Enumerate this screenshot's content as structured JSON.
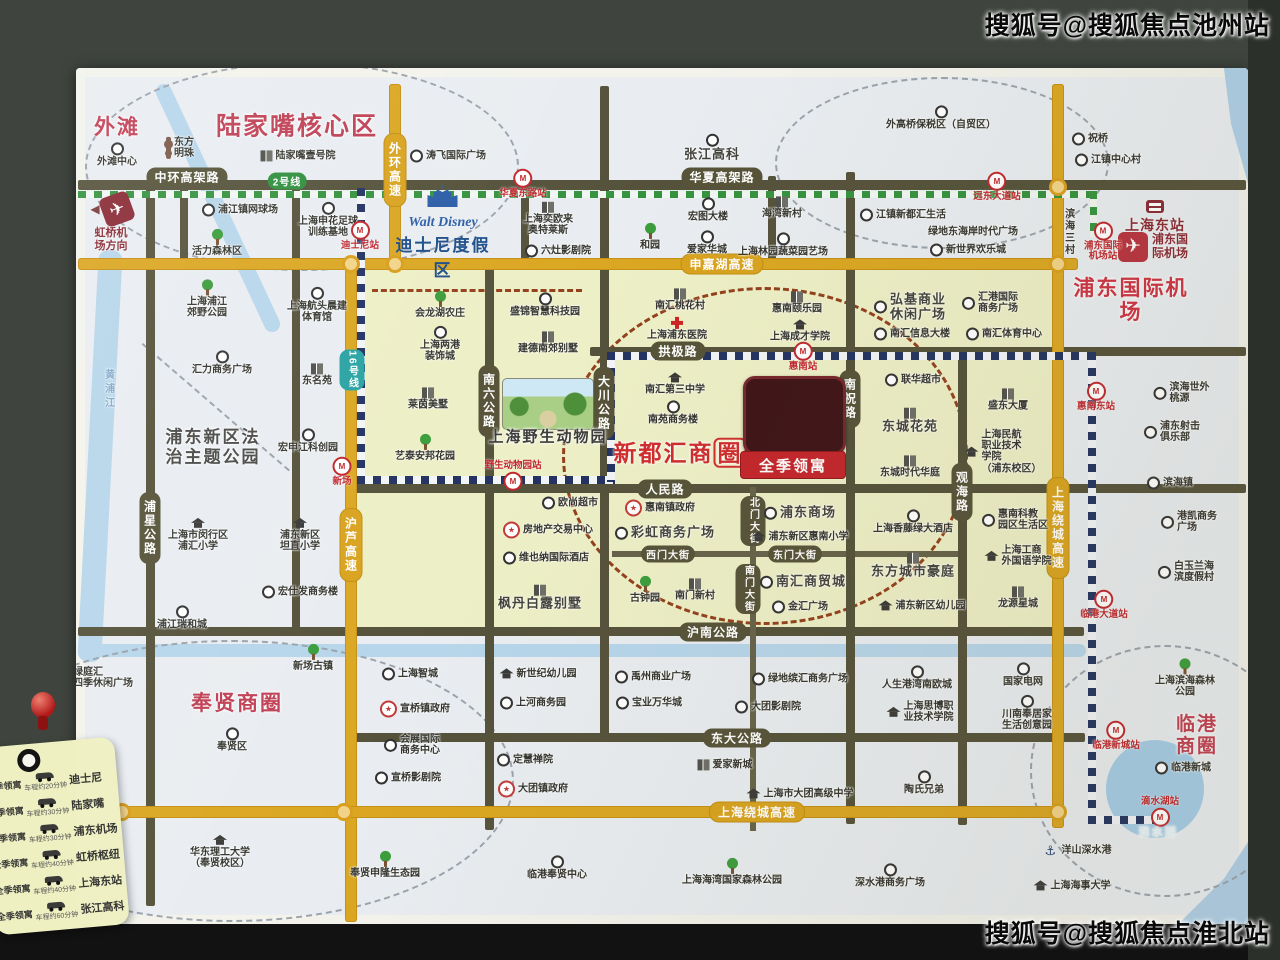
{
  "watermarks": {
    "top": "搜狐号@搜狐焦点池州站",
    "bottom": "搜狐号@搜狐焦点淮北站"
  },
  "project": {
    "name": "全季领寓"
  },
  "special": {
    "disney": {
      "logo": "Walt Disney",
      "title": "迪士尼度假区"
    },
    "hongqiao": {
      "label": "虹桥机\n场方向"
    },
    "east_station": {
      "label": "上海东站"
    },
    "airport_icon_label": "浦东国\n际机场"
  },
  "legend": {
    "origin": "全季领寓",
    "rows": [
      {
        "dest": "迪士尼",
        "time": "车程约20分钟"
      },
      {
        "dest": "陆家嘴",
        "time": "车程约30分钟"
      },
      {
        "dest": "浦东机场",
        "time": "车程约30分钟"
      },
      {
        "dest": "虹桥枢纽",
        "time": "车程约40分钟"
      },
      {
        "dest": "上海东站",
        "time": "车程约40分钟"
      },
      {
        "dest": "张江高科",
        "time": "车程约60分钟"
      }
    ]
  },
  "zones": [
    {
      "x": 351,
      "y": 264,
      "w": 713,
      "h": 370
    }
  ],
  "rivers": [
    {
      "x": 88,
      "y": 250,
      "w": 24,
      "h": 412,
      "r": 3
    },
    {
      "x": 210,
      "y": 72,
      "w": 16,
      "h": 272,
      "r": -25
    },
    {
      "x": 78,
      "y": 644,
      "w": 1008,
      "h": 13,
      "r": 0
    }
  ],
  "circles": [
    {
      "x": 85,
      "y": 62,
      "w": 430,
      "h": 205,
      "c": "gray"
    },
    {
      "x": 775,
      "y": 77,
      "w": 330,
      "h": 168,
      "c": "gray"
    },
    {
      "x": 1030,
      "y": 645,
      "w": 266,
      "h": 248,
      "c": "gray"
    },
    {
      "x": -50,
      "y": 640,
      "w": 560,
      "h": 278,
      "c": "gray"
    },
    {
      "x": 562,
      "y": 287,
      "w": 400,
      "h": 332,
      "c": "red"
    }
  ],
  "dsegs": [
    {
      "x": 143,
      "y": 343,
      "len": 194,
      "ang": 40.8,
      "c": "gray"
    },
    {
      "x": 372,
      "y": 289,
      "len": 210,
      "ang": 0,
      "c": "red"
    }
  ],
  "roads": [
    {
      "x": 78,
      "y": 180,
      "w": 1168,
      "h": 10,
      "t": "dark"
    },
    {
      "x": 590,
      "y": 347,
      "w": 656,
      "h": 9,
      "t": "dark"
    },
    {
      "x": 350,
      "y": 484,
      "w": 896,
      "h": 9,
      "t": "dark"
    },
    {
      "x": 612,
      "y": 551,
      "w": 348,
      "h": 6,
      "t": "thin"
    },
    {
      "x": 78,
      "y": 627,
      "w": 1006,
      "h": 9,
      "t": "dark"
    },
    {
      "x": 345,
      "y": 733,
      "w": 740,
      "h": 9,
      "t": "dark"
    },
    {
      "x": 146,
      "y": 186,
      "w": 9,
      "h": 720,
      "t": "dark"
    },
    {
      "x": 292,
      "y": 186,
      "w": 8,
      "h": 446,
      "t": "dark"
    },
    {
      "x": 600,
      "y": 86,
      "w": 9,
      "h": 652,
      "t": "dark"
    },
    {
      "x": 846,
      "y": 172,
      "w": 9,
      "h": 652,
      "t": "dark"
    },
    {
      "x": 958,
      "y": 347,
      "w": 9,
      "h": 478,
      "t": "dark"
    },
    {
      "x": 485,
      "y": 262,
      "w": 9,
      "h": 568,
      "t": "dark"
    },
    {
      "x": 521,
      "y": 186,
      "w": 8,
      "h": 84,
      "t": "dark"
    },
    {
      "x": 768,
      "y": 176,
      "w": 8,
      "h": 94,
      "t": "dark"
    },
    {
      "x": 750,
      "y": 487,
      "w": 6,
      "h": 344,
      "t": "thin"
    },
    {
      "x": 180,
      "y": 186,
      "w": 8,
      "h": 82,
      "t": "dark"
    }
  ],
  "yroads": [
    {
      "x": 389,
      "y": 84,
      "w": 12,
      "h": 184
    },
    {
      "x": 78,
      "y": 258,
      "w": 1000,
      "h": 12
    },
    {
      "x": 345,
      "y": 258,
      "w": 12,
      "h": 664
    },
    {
      "x": 1052,
      "y": 84,
      "w": 12,
      "h": 744
    },
    {
      "x": 78,
      "y": 806,
      "w": 988,
      "h": 12
    }
  ],
  "rails": [
    {
      "x": 78,
      "y": 191,
      "w": 1016,
      "h": 7,
      "o": "h",
      "l": "l2"
    },
    {
      "x": 1090,
      "y": 191,
      "w": 7,
      "h": 46,
      "o": "v",
      "l": "l2"
    },
    {
      "x": 357,
      "y": 188,
      "w": 8,
      "h": 294,
      "o": "v",
      "l": "l16"
    },
    {
      "x": 357,
      "y": 476,
      "w": 258,
      "h": 8,
      "o": "h",
      "l": "l16"
    },
    {
      "x": 607,
      "y": 352,
      "w": 8,
      "h": 130,
      "o": "v",
      "l": "l16"
    },
    {
      "x": 607,
      "y": 352,
      "w": 488,
      "h": 8,
      "o": "h",
      "l": "l16"
    },
    {
      "x": 1088,
      "y": 352,
      "w": 8,
      "h": 470,
      "o": "v",
      "l": "l16"
    },
    {
      "x": 1088,
      "y": 816,
      "w": 66,
      "h": 8,
      "o": "h",
      "l": "l16"
    }
  ],
  "nodes": [
    {
      "x": 351,
      "y": 264
    },
    {
      "x": 395,
      "y": 264
    },
    {
      "x": 1058,
      "y": 187
    },
    {
      "x": 1058,
      "y": 264
    },
    {
      "x": 122,
      "y": 812
    },
    {
      "x": 344,
      "y": 812
    },
    {
      "x": 1058,
      "y": 812
    }
  ],
  "road_labels": [
    {
      "t": "中环高架路",
      "x": 187,
      "y": 177,
      "c": "dark"
    },
    {
      "t": "华夏高架路",
      "x": 722,
      "y": 177,
      "c": "dark"
    },
    {
      "t": "拱极路",
      "x": 678,
      "y": 351,
      "c": "dark"
    },
    {
      "t": "人民路",
      "x": 665,
      "y": 489,
      "c": "dark"
    },
    {
      "t": "西门大街",
      "x": 668,
      "y": 554,
      "c": "dark",
      "sm": 1
    },
    {
      "t": "东门大街",
      "x": 795,
      "y": 554,
      "c": "dark",
      "sm": 1
    },
    {
      "t": "沪南公路",
      "x": 713,
      "y": 632,
      "c": "dark"
    },
    {
      "t": "东大公路",
      "x": 737,
      "y": 738,
      "c": "dark"
    },
    {
      "t": "北门大街",
      "x": 753,
      "y": 521,
      "c": "dark",
      "v": 1,
      "sm": 1
    },
    {
      "t": "南门大街",
      "x": 748,
      "y": 589,
      "c": "dark",
      "v": 1,
      "sm": 1
    },
    {
      "t": "浦星公路",
      "x": 150,
      "y": 528,
      "c": "dark",
      "v": 1
    },
    {
      "t": "南六公路",
      "x": 489,
      "y": 401,
      "c": "dark",
      "v": 1
    },
    {
      "t": "大川公路",
      "x": 604,
      "y": 403,
      "c": "dark",
      "v": 1
    },
    {
      "t": "南祝路",
      "x": 850,
      "y": 399,
      "c": "dark",
      "v": 1
    },
    {
      "t": "观海路",
      "x": 962,
      "y": 492,
      "c": "dark",
      "v": 1
    },
    {
      "t": "外环高速",
      "x": 395,
      "y": 170,
      "c": "yellow",
      "v": 1
    },
    {
      "t": "申嘉湖高速",
      "x": 722,
      "y": 264,
      "c": "yellow"
    },
    {
      "t": "沪芦高速",
      "x": 351,
      "y": 545,
      "c": "yellow",
      "v": 1
    },
    {
      "t": "上海绕城高速",
      "x": 1058,
      "y": 528,
      "c": "yellow",
      "v": 1
    },
    {
      "t": "上海绕城高速",
      "x": 757,
      "y": 812,
      "c": "yellow"
    },
    {
      "t": "2号线",
      "x": 287,
      "y": 181,
      "c": "green",
      "sm": 1
    },
    {
      "t": "16号线",
      "x": 352,
      "y": 370,
      "c": "teal",
      "v": 1,
      "sm": 1
    }
  ],
  "stations": [
    {
      "t": "迪士尼站",
      "x": 360,
      "y": 236
    },
    {
      "t": "华夏东路站",
      "x": 523,
      "y": 184
    },
    {
      "t": "远东大道站",
      "x": 997,
      "y": 187
    },
    {
      "t": "浦东国际\n机场站",
      "x": 1103,
      "y": 242
    },
    {
      "t": "新场",
      "x": 342,
      "y": 472
    },
    {
      "t": "野生动物园站",
      "x": 513,
      "y": 476,
      "lp": "t"
    },
    {
      "t": "惠南站",
      "x": 803,
      "y": 357
    },
    {
      "t": "惠南东站",
      "x": 1096,
      "y": 397
    },
    {
      "t": "临港大道站",
      "x": 1104,
      "y": 605
    },
    {
      "t": "临港新城站",
      "x": 1116,
      "y": 736
    },
    {
      "t": "滴水湖站",
      "x": 1160,
      "y": 812,
      "lp": "t"
    }
  ],
  "area_labels": [
    {
      "t": "外滩",
      "x": 117,
      "y": 128,
      "fs": 21,
      "c": "#c04055"
    },
    {
      "t": "陆家嘴核心区",
      "x": 297,
      "y": 127,
      "fs": 25,
      "c": "#c04055"
    },
    {
      "t": "新都汇商圈",
      "x": 680,
      "y": 453,
      "fs": 23,
      "c": "#cf2d2d",
      "box": 1
    },
    {
      "t": "奉贤商圈",
      "x": 237,
      "y": 704,
      "fs": 21,
      "c": "#c04055"
    },
    {
      "t": "临港商圈",
      "x": 1197,
      "y": 736,
      "fs": 19,
      "c": "#c04055"
    },
    {
      "t": "浦东国际机场",
      "x": 1131,
      "y": 301,
      "fs": 21,
      "c": "#cd3344"
    },
    {
      "t": "浦东新区法\n治主题公园",
      "x": 213,
      "y": 447,
      "fs": 17,
      "c": "#4a4a48"
    },
    {
      "t": "上海野生动物园",
      "x": 548,
      "y": 437,
      "fs": 15,
      "c": "#3c3c3a"
    },
    {
      "t": "滴水湖",
      "x": 1158,
      "y": 833,
      "fs": 11,
      "c": "#e4f2f8"
    }
  ],
  "pois": [
    {
      "t": "外滩中心",
      "x": 117,
      "y": 155,
      "i": "ring",
      "p": "t"
    },
    {
      "t": "东方\n明珠",
      "x": 180,
      "y": 148,
      "i": "tower",
      "p": "l"
    },
    {
      "t": "陆家嘴壹号院",
      "x": 298,
      "y": 156,
      "i": "bldg",
      "p": "l"
    },
    {
      "t": "涛飞国际广场",
      "x": 448,
      "y": 156,
      "i": "ring",
      "p": "l"
    },
    {
      "t": "张江高科",
      "x": 712,
      "y": 148,
      "i": "ring",
      "p": "t",
      "s": "lg"
    },
    {
      "t": "外高桥保税区（自贸区）",
      "x": 941,
      "y": 118,
      "i": "ring",
      "p": "t"
    },
    {
      "t": "祝桥",
      "x": 1090,
      "y": 139,
      "i": "ring",
      "p": "l"
    },
    {
      "t": "江镇中心村",
      "x": 1108,
      "y": 160,
      "i": "ring",
      "p": "l"
    },
    {
      "t": "浦江镇网球场",
      "x": 240,
      "y": 210,
      "i": "ring",
      "p": "l"
    },
    {
      "t": "活力森林区",
      "x": 217,
      "y": 243,
      "i": "tree",
      "p": "t"
    },
    {
      "t": "上海申花足球\n训练基地",
      "x": 328,
      "y": 220,
      "i": "ring",
      "p": "t"
    },
    {
      "t": "上海浦江\n郊野公园",
      "x": 207,
      "y": 299,
      "i": "tree",
      "p": "t"
    },
    {
      "t": "上海航头晨建\n体育馆",
      "x": 317,
      "y": 305,
      "i": "ring",
      "p": "t"
    },
    {
      "t": "上海奕欧来\n奥特莱斯",
      "x": 548,
      "y": 219,
      "i": "bldg",
      "p": "t"
    },
    {
      "t": "六灶影剧院",
      "x": 558,
      "y": 251,
      "i": "ring",
      "p": "l"
    },
    {
      "t": "和园",
      "x": 650,
      "y": 237,
      "i": "tree",
      "p": "t"
    },
    {
      "t": "宏图大楼",
      "x": 708,
      "y": 210,
      "i": "ring",
      "p": "t"
    },
    {
      "t": "海湾新村",
      "x": 782,
      "y": 208,
      "i": "bldg",
      "p": "t"
    },
    {
      "t": "爱家华城",
      "x": 707,
      "y": 243,
      "i": "ring",
      "p": "t"
    },
    {
      "t": "上海林园蔬菜园艺场",
      "x": 783,
      "y": 245,
      "i": "ring",
      "p": "t"
    },
    {
      "t": "江镇新都汇生活",
      "x": 903,
      "y": 215,
      "i": "ring",
      "p": "l"
    },
    {
      "t": "绿地东海岸时代广场",
      "x": 973,
      "y": 232,
      "p": "l"
    },
    {
      "t": "新世界欢乐城",
      "x": 968,
      "y": 250,
      "i": "ring",
      "p": "l"
    },
    {
      "t": "滨海三村",
      "x": 1068,
      "y": 232,
      "v": 1,
      "p": "l"
    },
    {
      "t": "黄浦江",
      "x": 108,
      "y": 390,
      "v": 1,
      "p": "l",
      "s": "river-t"
    },
    {
      "t": "会龙湖农庄",
      "x": 440,
      "y": 305,
      "i": "tree",
      "p": "t"
    },
    {
      "t": "盛锦智慧科技园",
      "x": 545,
      "y": 305,
      "i": "ring",
      "p": "t"
    },
    {
      "t": "南汇桃花村",
      "x": 680,
      "y": 300,
      "i": "bldg",
      "p": "t"
    },
    {
      "t": "上海浦东医院",
      "x": 677,
      "y": 329,
      "i": "cross",
      "p": "t"
    },
    {
      "t": "惠南颐乐园",
      "x": 797,
      "y": 303,
      "i": "bldg",
      "p": "t"
    },
    {
      "t": "上海成才学院",
      "x": 800,
      "y": 331,
      "i": "school",
      "p": "t"
    },
    {
      "t": "弘基商业\n休闲广场",
      "x": 910,
      "y": 307,
      "i": "ring",
      "p": "l",
      "s": "lg"
    },
    {
      "t": "汇港国际\n商务广场",
      "x": 990,
      "y": 303,
      "i": "ring",
      "p": "l"
    },
    {
      "t": "南汇信息大楼",
      "x": 912,
      "y": 334,
      "i": "ring",
      "p": "l"
    },
    {
      "t": "南汇体育中心",
      "x": 1004,
      "y": 334,
      "i": "ring",
      "p": "l"
    },
    {
      "t": "上海两港\n装饰城",
      "x": 440,
      "y": 344,
      "i": "ring",
      "p": "t"
    },
    {
      "t": "建德南郊别墅",
      "x": 548,
      "y": 343,
      "i": "bldg",
      "p": "t"
    },
    {
      "t": "莱茵美墅",
      "x": 428,
      "y": 399,
      "i": "bldg",
      "p": "t"
    },
    {
      "t": "艺泰安邦花园",
      "x": 425,
      "y": 448,
      "i": "tree",
      "p": "t"
    },
    {
      "t": "汇力商务广场",
      "x": 222,
      "y": 363,
      "i": "ring",
      "p": "t"
    },
    {
      "t": "东名苑",
      "x": 317,
      "y": 375,
      "i": "bldg",
      "p": "t"
    },
    {
      "t": "宏申江科创园",
      "x": 308,
      "y": 441,
      "i": "ring",
      "p": "t"
    },
    {
      "t": "上海市闵行区\n浦汇小学",
      "x": 198,
      "y": 535,
      "i": "school",
      "p": "t"
    },
    {
      "t": "浦东新区\n坦直小学",
      "x": 300,
      "y": 535,
      "i": "school",
      "p": "t"
    },
    {
      "t": "宏仕发商务楼",
      "x": 300,
      "y": 592,
      "i": "ring",
      "p": "l"
    },
    {
      "t": "浦江瑞和城",
      "x": 182,
      "y": 618,
      "i": "ring",
      "p": "t"
    },
    {
      "t": "南汇第三中学",
      "x": 675,
      "y": 384,
      "i": "school",
      "p": "t"
    },
    {
      "t": "南苑商务楼",
      "x": 673,
      "y": 413,
      "i": "ring",
      "p": "t"
    },
    {
      "t": "联华超市",
      "x": 913,
      "y": 380,
      "i": "ring",
      "p": "l"
    },
    {
      "t": "东城花苑",
      "x": 910,
      "y": 421,
      "i": "bldg",
      "p": "t",
      "s": "lg"
    },
    {
      "t": "盛东大厦",
      "x": 1008,
      "y": 400,
      "i": "bldg",
      "p": "t"
    },
    {
      "t": "上海民航\n职业技术\n学院\n（浦东校区）",
      "x": 1003,
      "y": 452,
      "i": "school",
      "p": "l"
    },
    {
      "t": "东城时代华庭",
      "x": 910,
      "y": 467,
      "i": "bldg",
      "p": "t"
    },
    {
      "t": "欧尚超市",
      "x": 570,
      "y": 503,
      "i": "ring",
      "p": "l"
    },
    {
      "t": "房地产交易中心",
      "x": 548,
      "y": 530,
      "i": "star",
      "p": "l"
    },
    {
      "t": "维也纳国际酒店",
      "x": 546,
      "y": 558,
      "i": "ring",
      "p": "l"
    },
    {
      "t": "枫丹白露别墅",
      "x": 540,
      "y": 598,
      "i": "bldg",
      "p": "t",
      "s": "lg"
    },
    {
      "t": "惠南镇政府",
      "x": 660,
      "y": 508,
      "i": "star",
      "p": "l"
    },
    {
      "t": "彩虹商务广场",
      "x": 665,
      "y": 533,
      "i": "ring",
      "p": "l",
      "s": "lg"
    },
    {
      "t": "古钟园",
      "x": 645,
      "y": 590,
      "i": "tree",
      "p": "t"
    },
    {
      "t": "南门新村",
      "x": 695,
      "y": 590,
      "i": "bldg",
      "p": "t"
    },
    {
      "t": "浦东商场",
      "x": 800,
      "y": 513,
      "i": "ring",
      "p": "l",
      "s": "lg"
    },
    {
      "t": "浦东新区惠南小学",
      "x": 800,
      "y": 537,
      "i": "school",
      "p": "l"
    },
    {
      "t": "南汇商贸城",
      "x": 803,
      "y": 582,
      "i": "ring",
      "p": "l",
      "s": "lg"
    },
    {
      "t": "金汇广场",
      "x": 800,
      "y": 607,
      "i": "ring",
      "p": "l"
    },
    {
      "t": "上海香藤绿大酒店",
      "x": 913,
      "y": 522,
      "i": "ring",
      "p": "t"
    },
    {
      "t": "东方城市豪庭",
      "x": 913,
      "y": 566,
      "i": "bldg",
      "p": "t",
      "s": "lg"
    },
    {
      "t": "浦东新区幼儿园",
      "x": 922,
      "y": 606,
      "i": "school",
      "p": "l"
    },
    {
      "t": "惠南科教\n园区生活区",
      "x": 1015,
      "y": 520,
      "i": "ring",
      "p": "l"
    },
    {
      "t": "上海工商\n外国语学院",
      "x": 1018,
      "y": 556,
      "i": "school",
      "p": "l"
    },
    {
      "t": "龙源星城",
      "x": 1018,
      "y": 598,
      "i": "bldg",
      "p": "t"
    },
    {
      "t": "绿庭汇\n四季休闲广场",
      "x": 95,
      "y": 678,
      "i": "ring",
      "p": "l"
    },
    {
      "t": "新场古镇",
      "x": 313,
      "y": 658,
      "i": "tree",
      "p": "t"
    },
    {
      "t": "奉贤区",
      "x": 232,
      "y": 740,
      "i": "ring",
      "p": "t"
    },
    {
      "t": "上海智城",
      "x": 410,
      "y": 674,
      "i": "ring",
      "p": "l"
    },
    {
      "t": "宣桥镇政府",
      "x": 415,
      "y": 709,
      "i": "star",
      "p": "l"
    },
    {
      "t": "会展国际\n商务中心",
      "x": 412,
      "y": 745,
      "i": "ring",
      "p": "l"
    },
    {
      "t": "宣桥影剧院",
      "x": 408,
      "y": 778,
      "i": "ring",
      "p": "l"
    },
    {
      "t": "新世纪幼儿园",
      "x": 538,
      "y": 674,
      "i": "school",
      "p": "l"
    },
    {
      "t": "上河商务园",
      "x": 533,
      "y": 703,
      "i": "ring",
      "p": "l"
    },
    {
      "t": "禹州商业广场",
      "x": 653,
      "y": 677,
      "i": "ring",
      "p": "l"
    },
    {
      "t": "宝业万华城",
      "x": 649,
      "y": 703,
      "i": "ring",
      "p": "l"
    },
    {
      "t": "绿地缤汇商务广场",
      "x": 800,
      "y": 679,
      "i": "ring",
      "p": "l"
    },
    {
      "t": "大团影剧院",
      "x": 768,
      "y": 707,
      "i": "ring",
      "p": "l"
    },
    {
      "t": "定慧禅院",
      "x": 525,
      "y": 760,
      "i": "ring",
      "p": "l"
    },
    {
      "t": "大团镇政府",
      "x": 533,
      "y": 789,
      "i": "star",
      "p": "l"
    },
    {
      "t": "爱家新城",
      "x": 725,
      "y": 765,
      "i": "bldg",
      "p": "l"
    },
    {
      "t": "上海市大团高级中学",
      "x": 800,
      "y": 794,
      "i": "school",
      "p": "l"
    },
    {
      "t": "人生港湾南欧城",
      "x": 917,
      "y": 678,
      "i": "ring",
      "p": "t"
    },
    {
      "t": "上海思博职\n业技术学院",
      "x": 920,
      "y": 712,
      "i": "school",
      "p": "l"
    },
    {
      "t": "陶氏兄弟",
      "x": 924,
      "y": 783,
      "i": "ring",
      "p": "t"
    },
    {
      "t": "国家电网",
      "x": 1023,
      "y": 675,
      "i": "ring",
      "p": "t"
    },
    {
      "t": "川南奉居家\n生活创意园",
      "x": 1027,
      "y": 713,
      "i": "ring",
      "p": "t"
    },
    {
      "t": "上海滨海森林公园",
      "x": 1185,
      "y": 678,
      "i": "tree",
      "p": "t"
    },
    {
      "t": "临港新城",
      "x": 1183,
      "y": 768,
      "i": "ring",
      "p": "l"
    },
    {
      "t": "华东理工大学\n（奉贤校区）",
      "x": 220,
      "y": 852,
      "i": "school",
      "p": "t"
    },
    {
      "t": "奉贤申隆生态园",
      "x": 385,
      "y": 865,
      "i": "tree",
      "p": "t"
    },
    {
      "t": "临港奉贤中心",
      "x": 557,
      "y": 868,
      "i": "ring",
      "p": "t"
    },
    {
      "t": "上海海湾国家森林公园",
      "x": 732,
      "y": 872,
      "i": "tree",
      "p": "t"
    },
    {
      "t": "深水港商务广场",
      "x": 890,
      "y": 876,
      "i": "ring",
      "p": "t"
    },
    {
      "t": "洋山深水港",
      "x": 1078,
      "y": 851,
      "i": "anchor",
      "p": "l"
    },
    {
      "t": "上海海事大学",
      "x": 1072,
      "y": 886,
      "i": "school",
      "p": "l"
    },
    {
      "t": "滨海世外桃源",
      "x": 1185,
      "y": 393,
      "i": "ring",
      "p": "l"
    },
    {
      "t": "浦东射击\n俱乐部",
      "x": 1172,
      "y": 432,
      "i": "ring",
      "p": "l"
    },
    {
      "t": "滨海镇",
      "x": 1170,
      "y": 483,
      "i": "ring",
      "p": "l"
    },
    {
      "t": "港凯商务广场",
      "x": 1190,
      "y": 522,
      "i": "ring",
      "p": "l"
    },
    {
      "t": "白玉兰海滨度假村",
      "x": 1188,
      "y": 572,
      "i": "ring",
      "p": "l"
    }
  ]
}
